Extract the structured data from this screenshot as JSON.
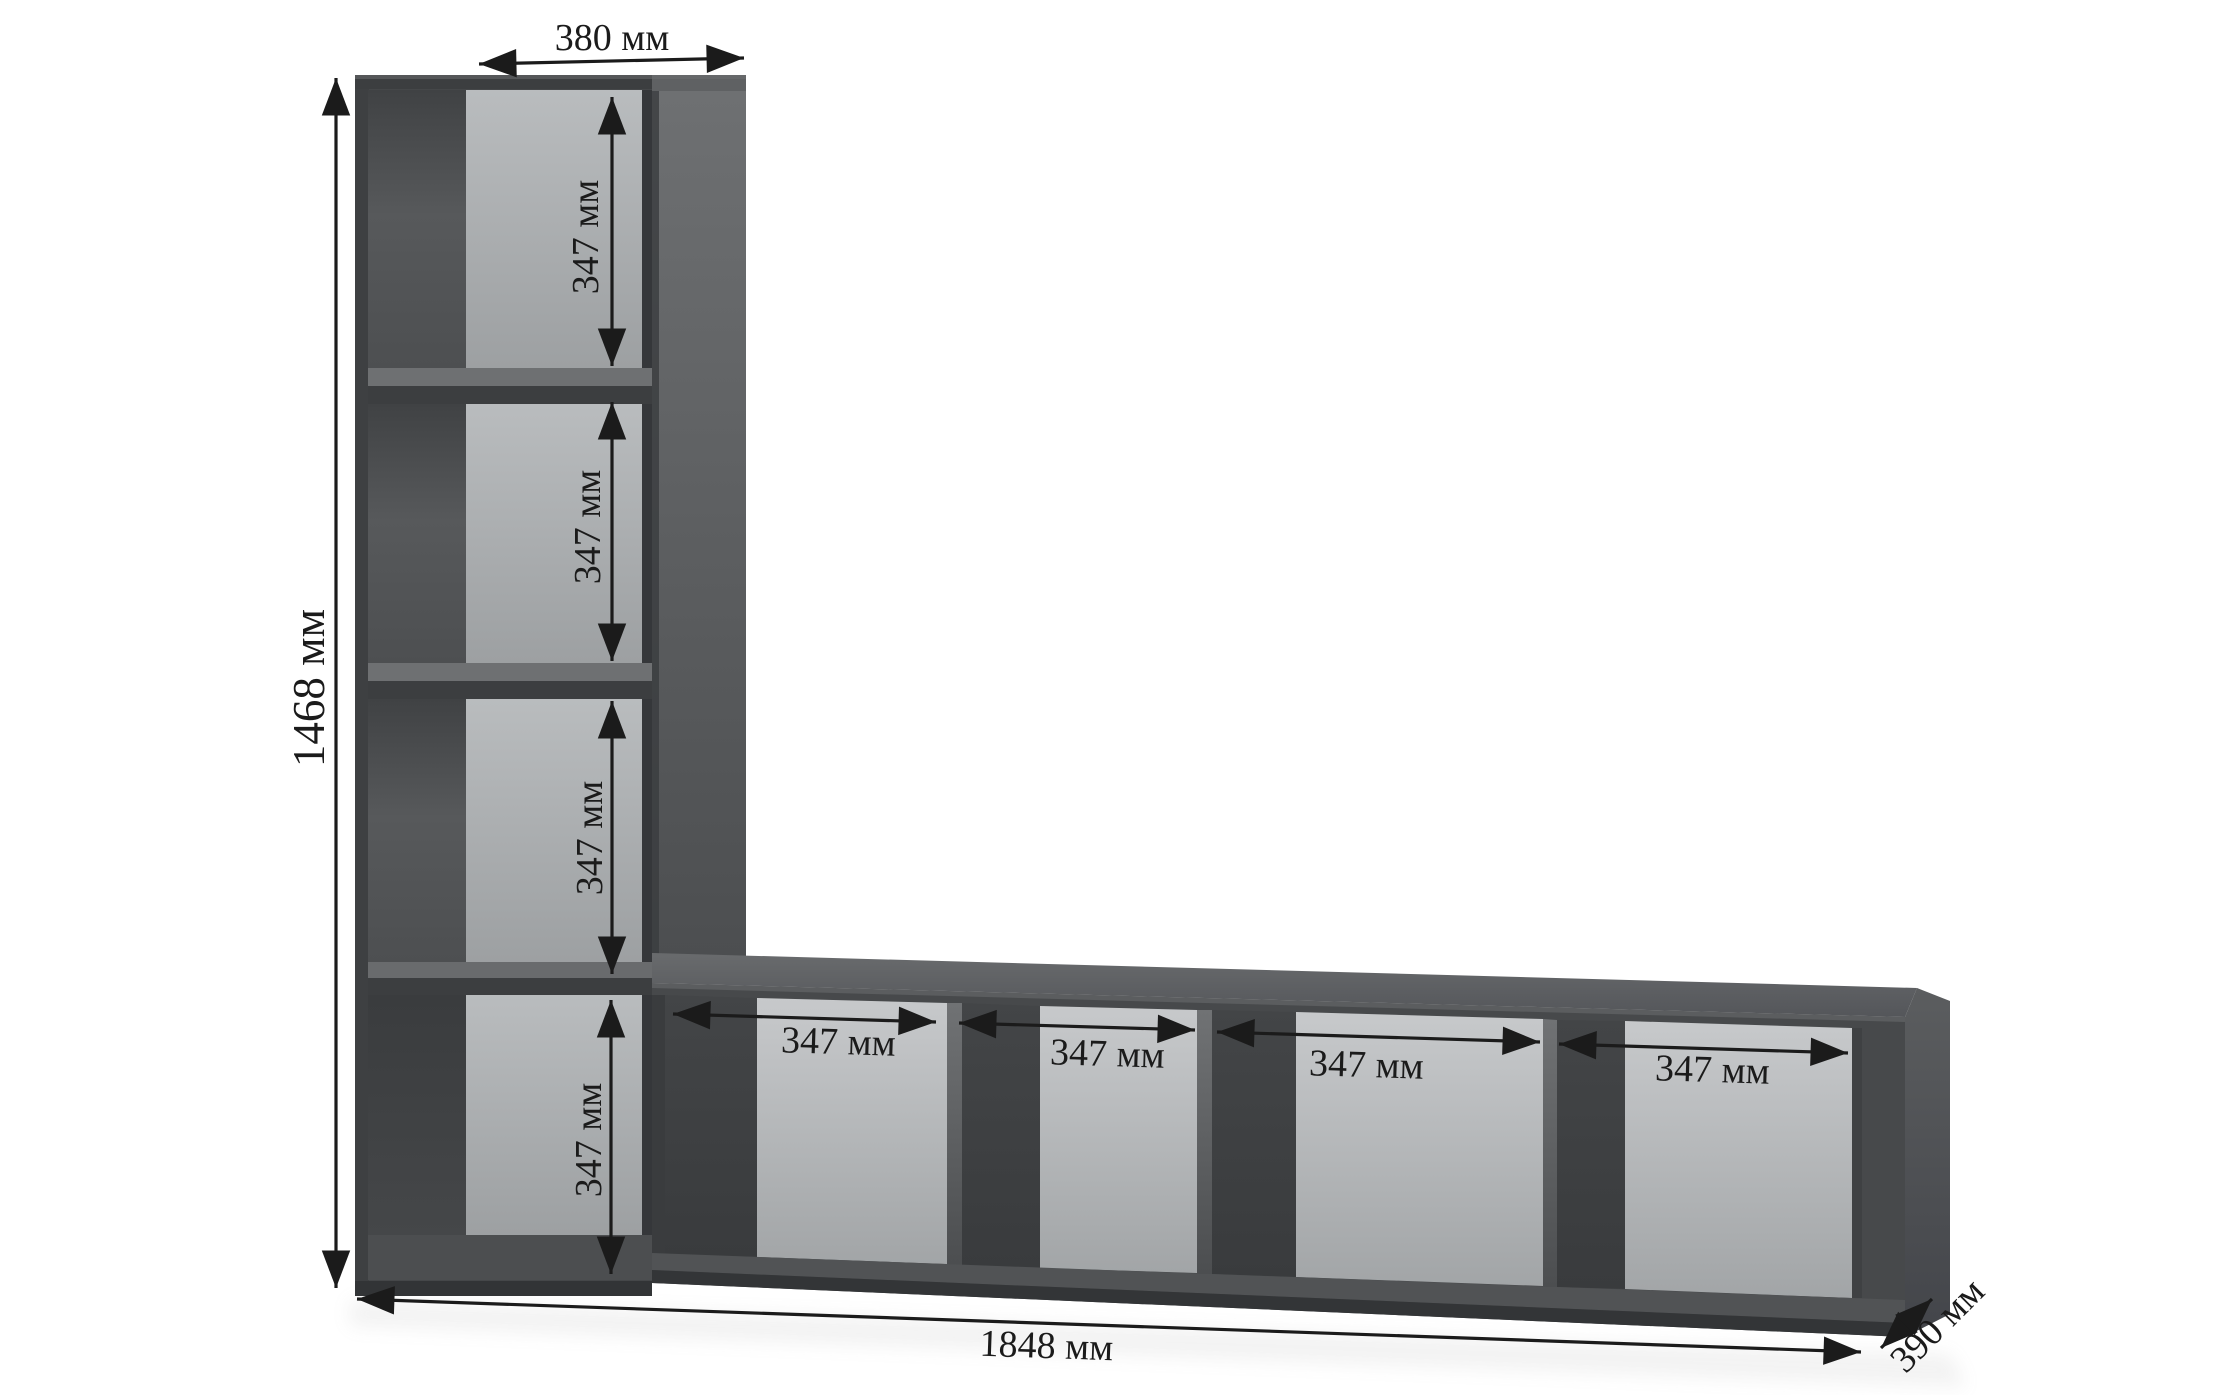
{
  "diagram": {
    "labels": {
      "top_width": "380 мм",
      "total_height": "1468 мм",
      "total_length": "1848 мм",
      "depth": "390 мм"
    },
    "column_cell_heights": [
      "347 мм",
      "347 мм",
      "347 мм",
      "347 мм"
    ],
    "row_cell_widths": [
      "347 мм",
      "347 мм",
      "347 мм",
      "347 мм"
    ],
    "colors": {
      "background": "#ffffff",
      "cabinet_front": "#47494b",
      "cabinet_edge_dark": "#333537",
      "cabinet_top_surface": "#5f6163",
      "interior_back_light": "#b9bcbe",
      "interior_shadow": "#3f4143",
      "dimension_ink": "#1b1b1b"
    }
  }
}
